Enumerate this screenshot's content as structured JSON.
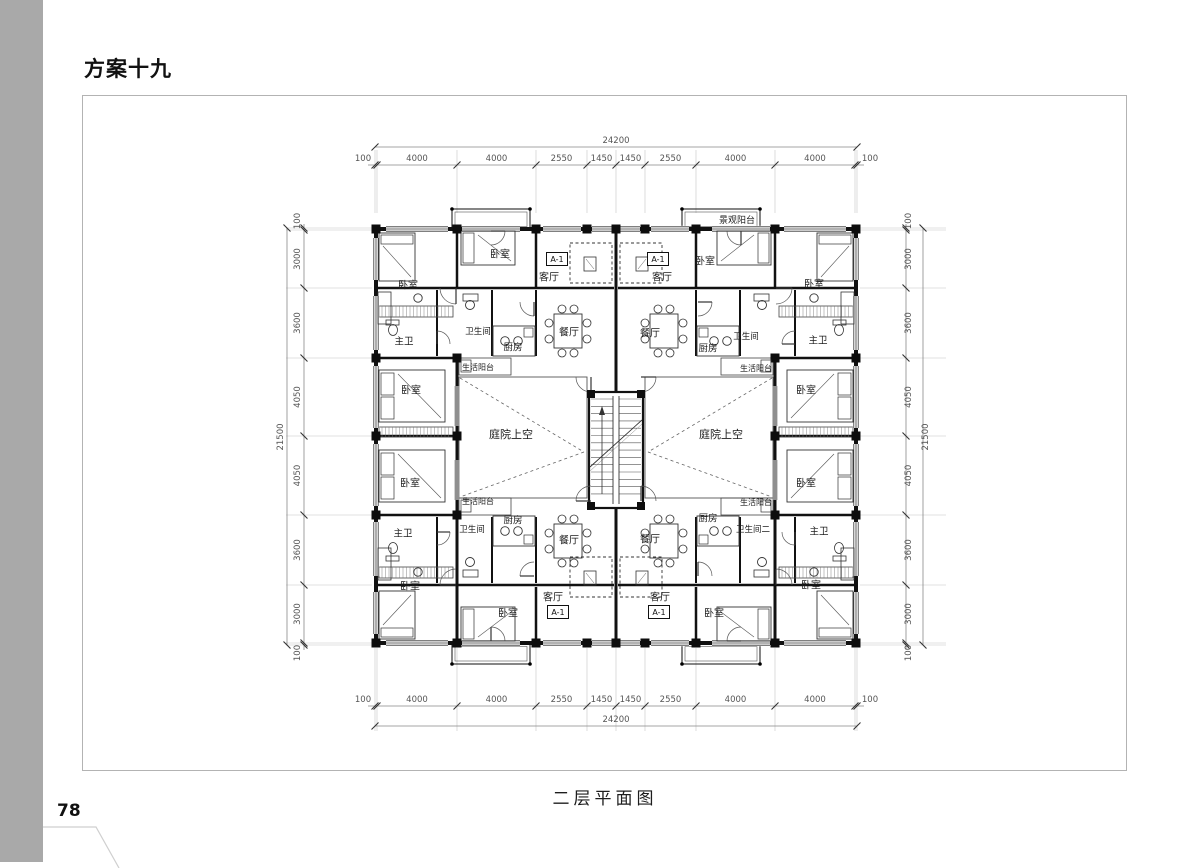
{
  "page": {
    "title": "方案十九",
    "caption": "二层平面图",
    "page_number": "78"
  },
  "colors": {
    "wall": "#1a1a1a",
    "dimension": "#555555",
    "extension": "#c4c4c4",
    "frame_border": "#b3b3b3",
    "sidebar_gray": "#a9a9a9"
  },
  "plan": {
    "dims": {
      "overall_width": "24200",
      "overall_height": "21500",
      "h_segments": [
        "100",
        "4000",
        "4000",
        "2550",
        "1450",
        "1450",
        "2550",
        "4000",
        "4000",
        "100"
      ],
      "v_segments": [
        "100",
        "3000",
        "3600",
        "4050",
        "4050",
        "3600",
        "3000",
        "100"
      ]
    },
    "labels": [
      {
        "text": "景观阳台",
        "x": 737,
        "y": 220,
        "s": 9
      },
      {
        "text": "卧室",
        "x": 408,
        "y": 285,
        "s": 10
      },
      {
        "text": "卧室",
        "x": 500,
        "y": 254,
        "s": 10
      },
      {
        "text": "客厅",
        "x": 549,
        "y": 277,
        "s": 10
      },
      {
        "text": "A-1",
        "x": 557,
        "y": 259,
        "s": 8,
        "box": true
      },
      {
        "text": "A-1",
        "x": 658,
        "y": 259,
        "s": 8,
        "box": true
      },
      {
        "text": "客厅",
        "x": 662,
        "y": 277,
        "s": 10
      },
      {
        "text": "卧室",
        "x": 705,
        "y": 261,
        "s": 10
      },
      {
        "text": "卧室",
        "x": 814,
        "y": 284,
        "s": 10
      },
      {
        "text": "主卫",
        "x": 404,
        "y": 341,
        "s": 9.5
      },
      {
        "text": "卫生间",
        "x": 478,
        "y": 331,
        "s": 8.5
      },
      {
        "text": "厨房",
        "x": 513,
        "y": 347,
        "s": 9.5
      },
      {
        "text": "餐厅",
        "x": 569,
        "y": 332,
        "s": 10
      },
      {
        "text": "餐厅",
        "x": 650,
        "y": 333,
        "s": 10
      },
      {
        "text": "厨房",
        "x": 708,
        "y": 348,
        "s": 9.5
      },
      {
        "text": "卫生间",
        "x": 746,
        "y": 336,
        "s": 8.5
      },
      {
        "text": "主卫",
        "x": 818,
        "y": 340,
        "s": 9.5
      },
      {
        "text": "生活阳台",
        "x": 478,
        "y": 367,
        "s": 8
      },
      {
        "text": "生活阳台",
        "x": 756,
        "y": 368,
        "s": 8
      },
      {
        "text": "卧室",
        "x": 411,
        "y": 390,
        "s": 10
      },
      {
        "text": "卧室",
        "x": 806,
        "y": 390,
        "s": 10
      },
      {
        "text": "庭院上空",
        "x": 511,
        "y": 434,
        "s": 11
      },
      {
        "text": "庭院上空",
        "x": 721,
        "y": 434,
        "s": 11
      },
      {
        "text": "卧室",
        "x": 410,
        "y": 483,
        "s": 10
      },
      {
        "text": "卧室",
        "x": 806,
        "y": 483,
        "s": 10
      },
      {
        "text": "生活阳台",
        "x": 478,
        "y": 501,
        "s": 8
      },
      {
        "text": "生活阳台",
        "x": 756,
        "y": 502,
        "s": 8
      },
      {
        "text": "主卫",
        "x": 403,
        "y": 533,
        "s": 9.5
      },
      {
        "text": "卫生间",
        "x": 472,
        "y": 529,
        "s": 8.5
      },
      {
        "text": "厨房",
        "x": 513,
        "y": 520,
        "s": 9.5
      },
      {
        "text": "餐厅",
        "x": 569,
        "y": 540,
        "s": 10
      },
      {
        "text": "餐厅",
        "x": 650,
        "y": 539,
        "s": 10
      },
      {
        "text": "厨房",
        "x": 708,
        "y": 518,
        "s": 9.5
      },
      {
        "text": "卫生间二",
        "x": 753,
        "y": 529,
        "s": 8.5
      },
      {
        "text": "主卫",
        "x": 819,
        "y": 531,
        "s": 9.5
      },
      {
        "text": "卧室",
        "x": 410,
        "y": 586,
        "s": 10
      },
      {
        "text": "卧室",
        "x": 508,
        "y": 613,
        "s": 10
      },
      {
        "text": "客厅",
        "x": 553,
        "y": 597,
        "s": 10
      },
      {
        "text": "A-1",
        "x": 558,
        "y": 612,
        "s": 8,
        "box": true
      },
      {
        "text": "A-1",
        "x": 659,
        "y": 612,
        "s": 8,
        "box": true
      },
      {
        "text": "客厅",
        "x": 660,
        "y": 597,
        "s": 10
      },
      {
        "text": "卧室",
        "x": 714,
        "y": 613,
        "s": 10
      },
      {
        "text": "卧室",
        "x": 811,
        "y": 585,
        "s": 10
      }
    ]
  }
}
